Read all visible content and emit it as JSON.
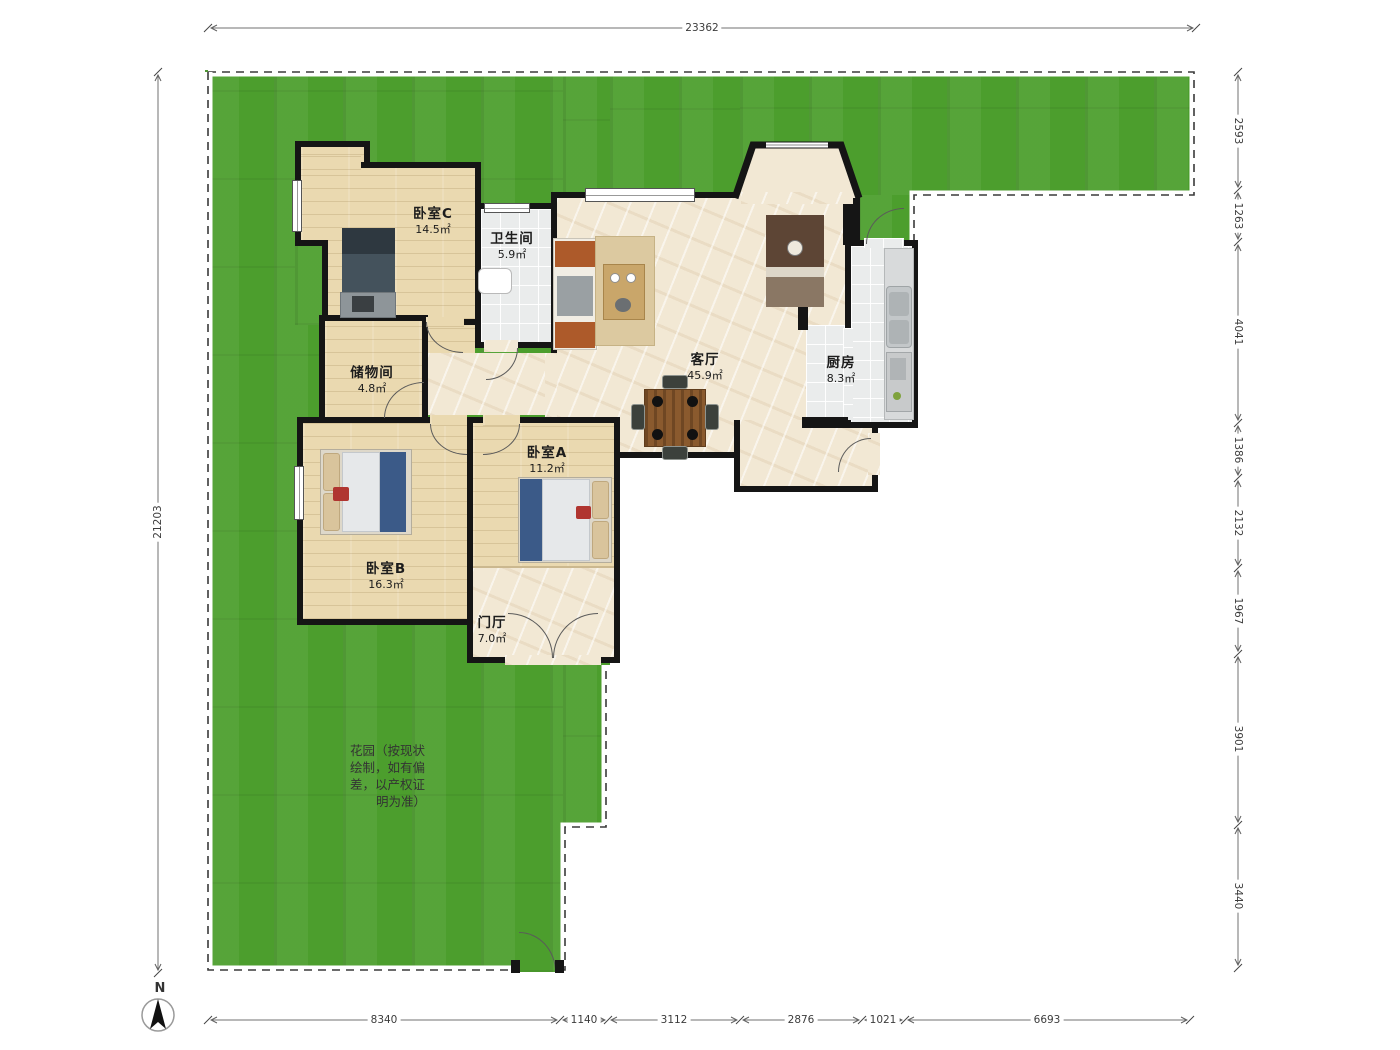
{
  "title": "apartment-floor-plan-with-garden",
  "rooms": [
    {
      "id": "bedroom-c",
      "name": "卧室C",
      "area": "14.5㎡"
    },
    {
      "id": "bathroom",
      "name": "卫生间",
      "area": "5.9㎡"
    },
    {
      "id": "storage",
      "name": "储物间",
      "area": "4.8㎡"
    },
    {
      "id": "bedroom-b",
      "name": "卧室B",
      "area": "16.3㎡"
    },
    {
      "id": "bedroom-a",
      "name": "卧室A",
      "area": "11.2㎡"
    },
    {
      "id": "entry-hall",
      "name": "门厅",
      "area": "7.0㎡"
    },
    {
      "id": "living",
      "name": "客厅",
      "area": "45.9㎡"
    },
    {
      "id": "kitchen",
      "name": "厨房",
      "area": "8.3㎡"
    }
  ],
  "garden": {
    "note_lines": [
      "花园（按现状",
      "绘制，如有偏",
      "差，以产权证",
      "明为准）"
    ]
  },
  "compass": {
    "label": "N"
  },
  "dims": {
    "top": [
      "23362"
    ],
    "left": [
      "21203"
    ],
    "right": [
      "2593",
      "1263",
      "4041",
      "1386",
      "2132",
      "1967",
      "3901",
      "3440"
    ],
    "bottom": [
      "8340",
      "1140",
      "3112",
      "2876",
      "1021",
      "6693"
    ]
  },
  "palette": {
    "grass": "#4c9e2d",
    "wood": "#ead9b0",
    "marble": "#f2e8d4",
    "tile": "#eaecec",
    "wall": "#151515"
  }
}
